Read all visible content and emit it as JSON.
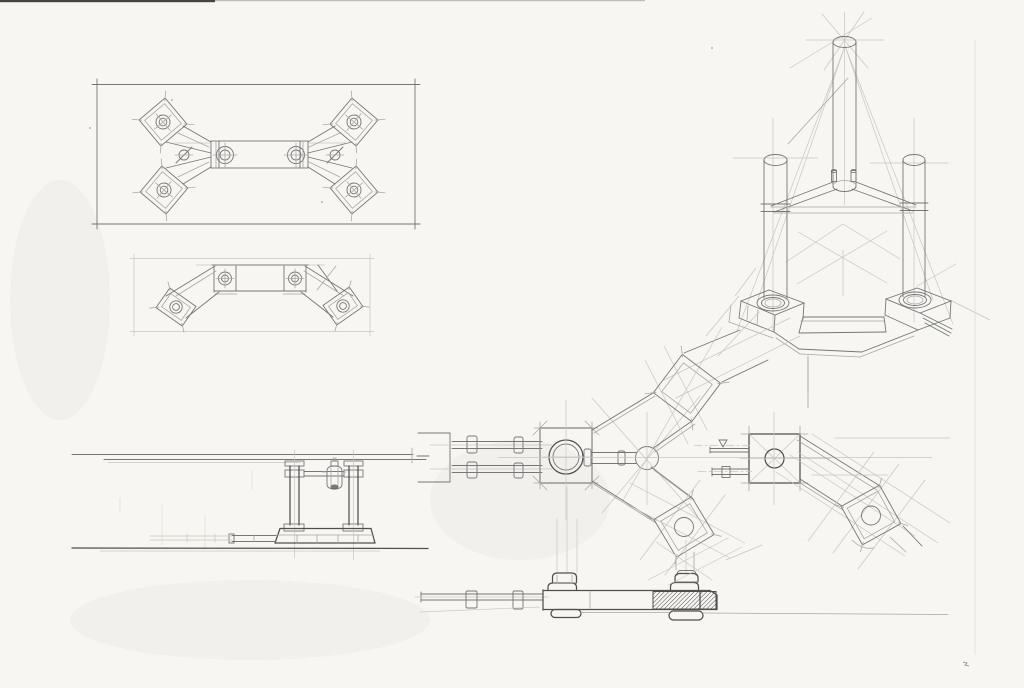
{
  "sheet": {
    "colors": {
      "paper-bg": "#f7f6f2",
      "pencil-dark": "#4f4f4f",
      "pencil-main": "#707070",
      "pencil-light": "#a9a8a4",
      "pencil-faint": "#c8c6c0",
      "scan-edge": "#454545",
      "crease": "#e4e2dd",
      "hatch-fill": "#4a4a4a"
    },
    "views": [
      {
        "id": "plan-view-bracket",
        "label": "Framed plan view of X-shaped bracket plate with four bolted corner pads and center bar"
      },
      {
        "id": "elevation-view-bracket",
        "label": "Front elevation of bracket with sloped arms and bolted end pads"
      },
      {
        "id": "perspective-view-tripod",
        "label": "Perspective construction study of three cylindrical legs on stepped base"
      },
      {
        "id": "plan-view-spider-hub",
        "label": "Plan view of three-armed spider hub with guide rails and rotated pads"
      },
      {
        "id": "plan-view-arm-detail",
        "label": "Plan detail of single arm with square pad, bolt fittings and rotated end pad"
      },
      {
        "id": "side-elevation-columns",
        "label": "Side elevation with twin columns, valve fitting and plinth"
      },
      {
        "id": "bottom-elevation-section",
        "label": "Side elevation of base beam with pedestals, hatched section and guide rod"
      }
    ]
  }
}
